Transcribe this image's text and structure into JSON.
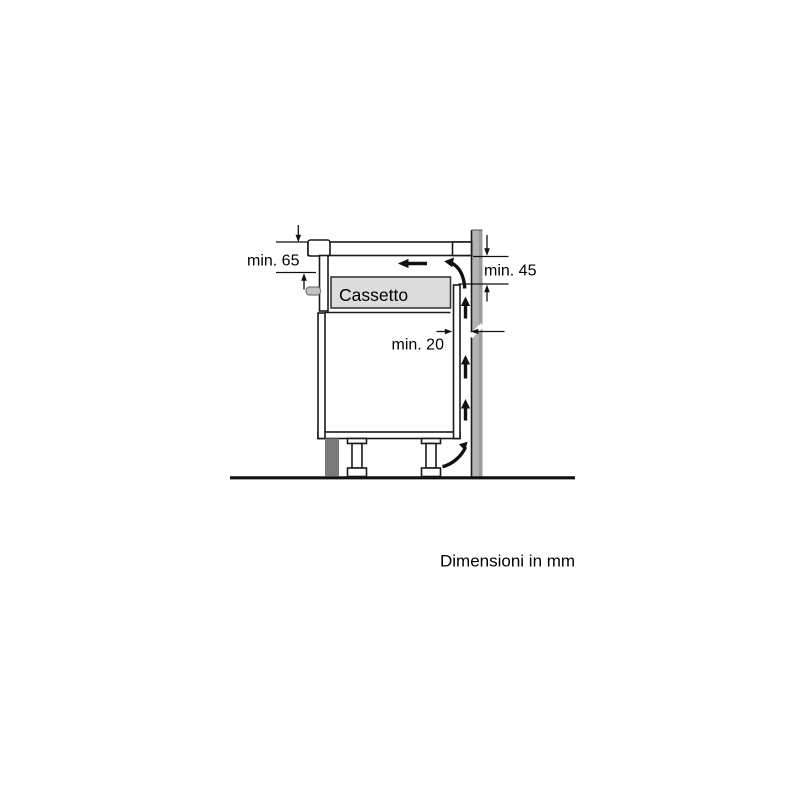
{
  "diagram": {
    "caption": "Dimensioni in mm",
    "labels": {
      "hob_depth": "min. 65",
      "vent_gap_top": "min. 45",
      "wall_gap": "min. 20",
      "drawer": "Cassetto"
    },
    "colors": {
      "line": "#1a1a1a",
      "wall": "#b4b4b4",
      "wall_edge": "#9c9c9c",
      "plinth": "#7a7a7a",
      "worktop_block": "#d2d2d2",
      "drawer_fill": "#dcdcdc",
      "clamp": "#c2c2c2"
    }
  }
}
